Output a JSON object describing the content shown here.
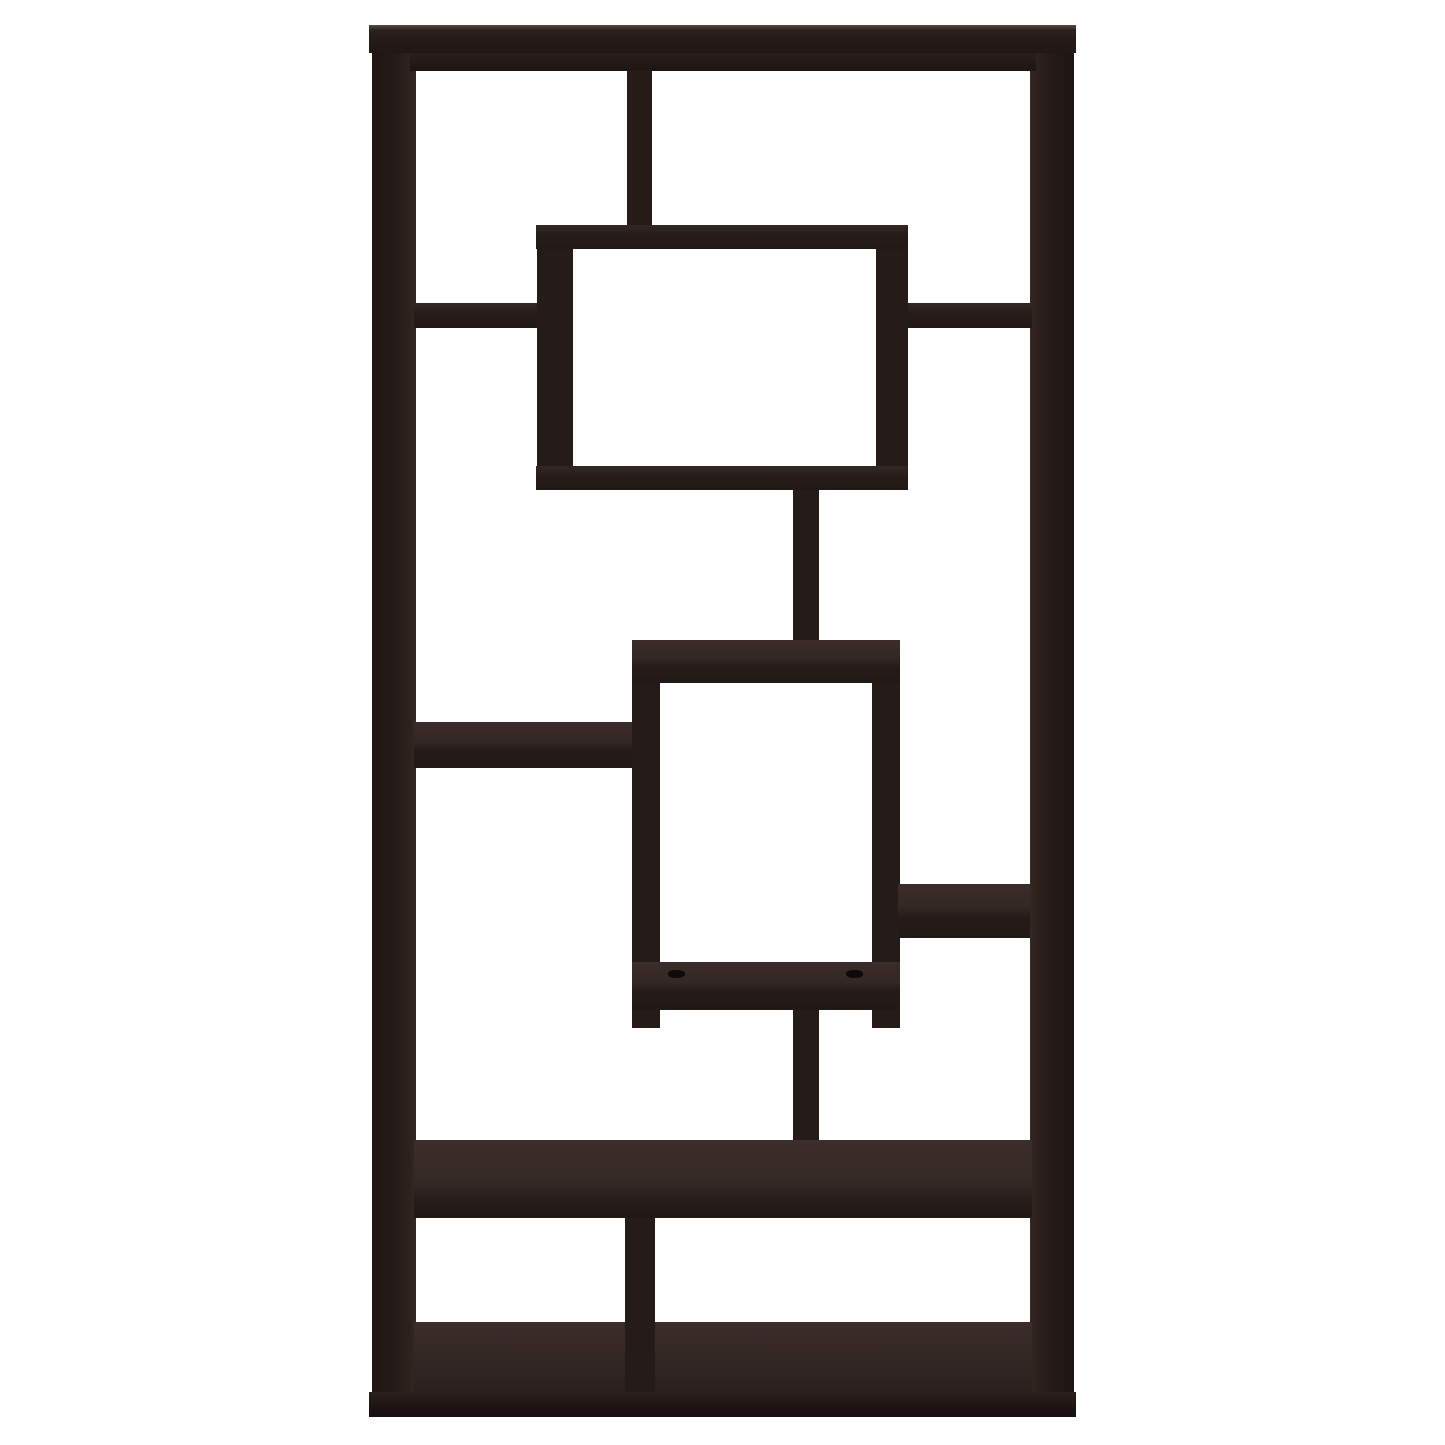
{
  "scene": {
    "kind": "product-photo",
    "subject": "10-shelf geometric staggered bookcase",
    "finish": "espresso-cappuccino dark wood",
    "background_color": "#ffffff",
    "wood_front_color": "#251b19",
    "wood_top_color": "#362a27",
    "wood_base_color": "#1b1210",
    "cap_highlight_color": "#5a4a40"
  },
  "parts": [
    {
      "name": "left-side-panel",
      "x": 372,
      "y": 52,
      "w": 44,
      "h": 1340,
      "tone": "panel-l"
    },
    {
      "name": "right-side-panel",
      "x": 1030,
      "y": 52,
      "w": 44,
      "h": 1340,
      "tone": "panel-r"
    },
    {
      "name": "top-under-rail",
      "x": 410,
      "y": 52,
      "w": 626,
      "h": 19,
      "tone": "rail"
    },
    {
      "name": "top-cap-board",
      "x": 369,
      "y": 25,
      "w": 707,
      "h": 28,
      "tone": "cap"
    },
    {
      "name": "top-center-divider",
      "x": 627,
      "y": 70,
      "w": 25,
      "h": 156,
      "tone": "face"
    },
    {
      "name": "upper-left-shelf",
      "x": 414,
      "y": 303,
      "w": 127,
      "h": 25,
      "tone": "shelf-thin"
    },
    {
      "name": "upper-right-shelf",
      "x": 902,
      "y": 303,
      "w": 130,
      "h": 25,
      "tone": "shelf-thin"
    },
    {
      "name": "upper-box-top-shelf",
      "x": 536,
      "y": 225,
      "w": 372,
      "h": 24,
      "tone": "shelf-thin"
    },
    {
      "name": "upper-box-left-panel",
      "x": 537,
      "y": 249,
      "w": 36,
      "h": 217,
      "tone": "face"
    },
    {
      "name": "upper-box-right-panel",
      "x": 876,
      "y": 249,
      "w": 32,
      "h": 217,
      "tone": "face"
    },
    {
      "name": "upper-box-bottom-shelf",
      "x": 536,
      "y": 466,
      "w": 372,
      "h": 24,
      "tone": "shelf-thin"
    },
    {
      "name": "center-divider-upper",
      "x": 793,
      "y": 490,
      "w": 26,
      "h": 152,
      "tone": "face"
    },
    {
      "name": "middle-box-top-shelf",
      "x": 632,
      "y": 640,
      "w": 268,
      "h": 43,
      "tone": "shelf-v"
    },
    {
      "name": "middle-box-left-panel",
      "x": 632,
      "y": 683,
      "w": 28,
      "h": 345,
      "tone": "face"
    },
    {
      "name": "middle-box-right-panel",
      "x": 872,
      "y": 683,
      "w": 28,
      "h": 345,
      "tone": "face"
    },
    {
      "name": "middle-box-bottom-shelf",
      "x": 632,
      "y": 962,
      "w": 268,
      "h": 48,
      "tone": "shelf-v"
    },
    {
      "name": "shelf-peg-hole-left",
      "x": 668,
      "y": 970,
      "w": 17,
      "h": 8,
      "tone": "hole"
    },
    {
      "name": "shelf-peg-hole-right",
      "x": 846,
      "y": 970,
      "w": 17,
      "h": 8,
      "tone": "hole"
    },
    {
      "name": "middle-left-shelf",
      "x": 414,
      "y": 722,
      "w": 218,
      "h": 46,
      "tone": "shelf-v"
    },
    {
      "name": "middle-right-shelf",
      "x": 898,
      "y": 884,
      "w": 132,
      "h": 54,
      "tone": "shelf-v"
    },
    {
      "name": "center-divider-lower",
      "x": 793,
      "y": 1010,
      "w": 26,
      "h": 130,
      "tone": "face"
    },
    {
      "name": "long-lower-shelf",
      "x": 414,
      "y": 1140,
      "w": 618,
      "h": 78,
      "tone": "shelf-big"
    },
    {
      "name": "bottom-floor-surface",
      "x": 414,
      "y": 1322,
      "w": 618,
      "h": 70,
      "tone": "top"
    },
    {
      "name": "bottom-center-divider",
      "x": 625,
      "y": 1218,
      "w": 30,
      "h": 174,
      "tone": "face"
    },
    {
      "name": "base-plinth",
      "x": 369,
      "y": 1392,
      "w": 707,
      "h": 25,
      "tone": "dark"
    }
  ]
}
